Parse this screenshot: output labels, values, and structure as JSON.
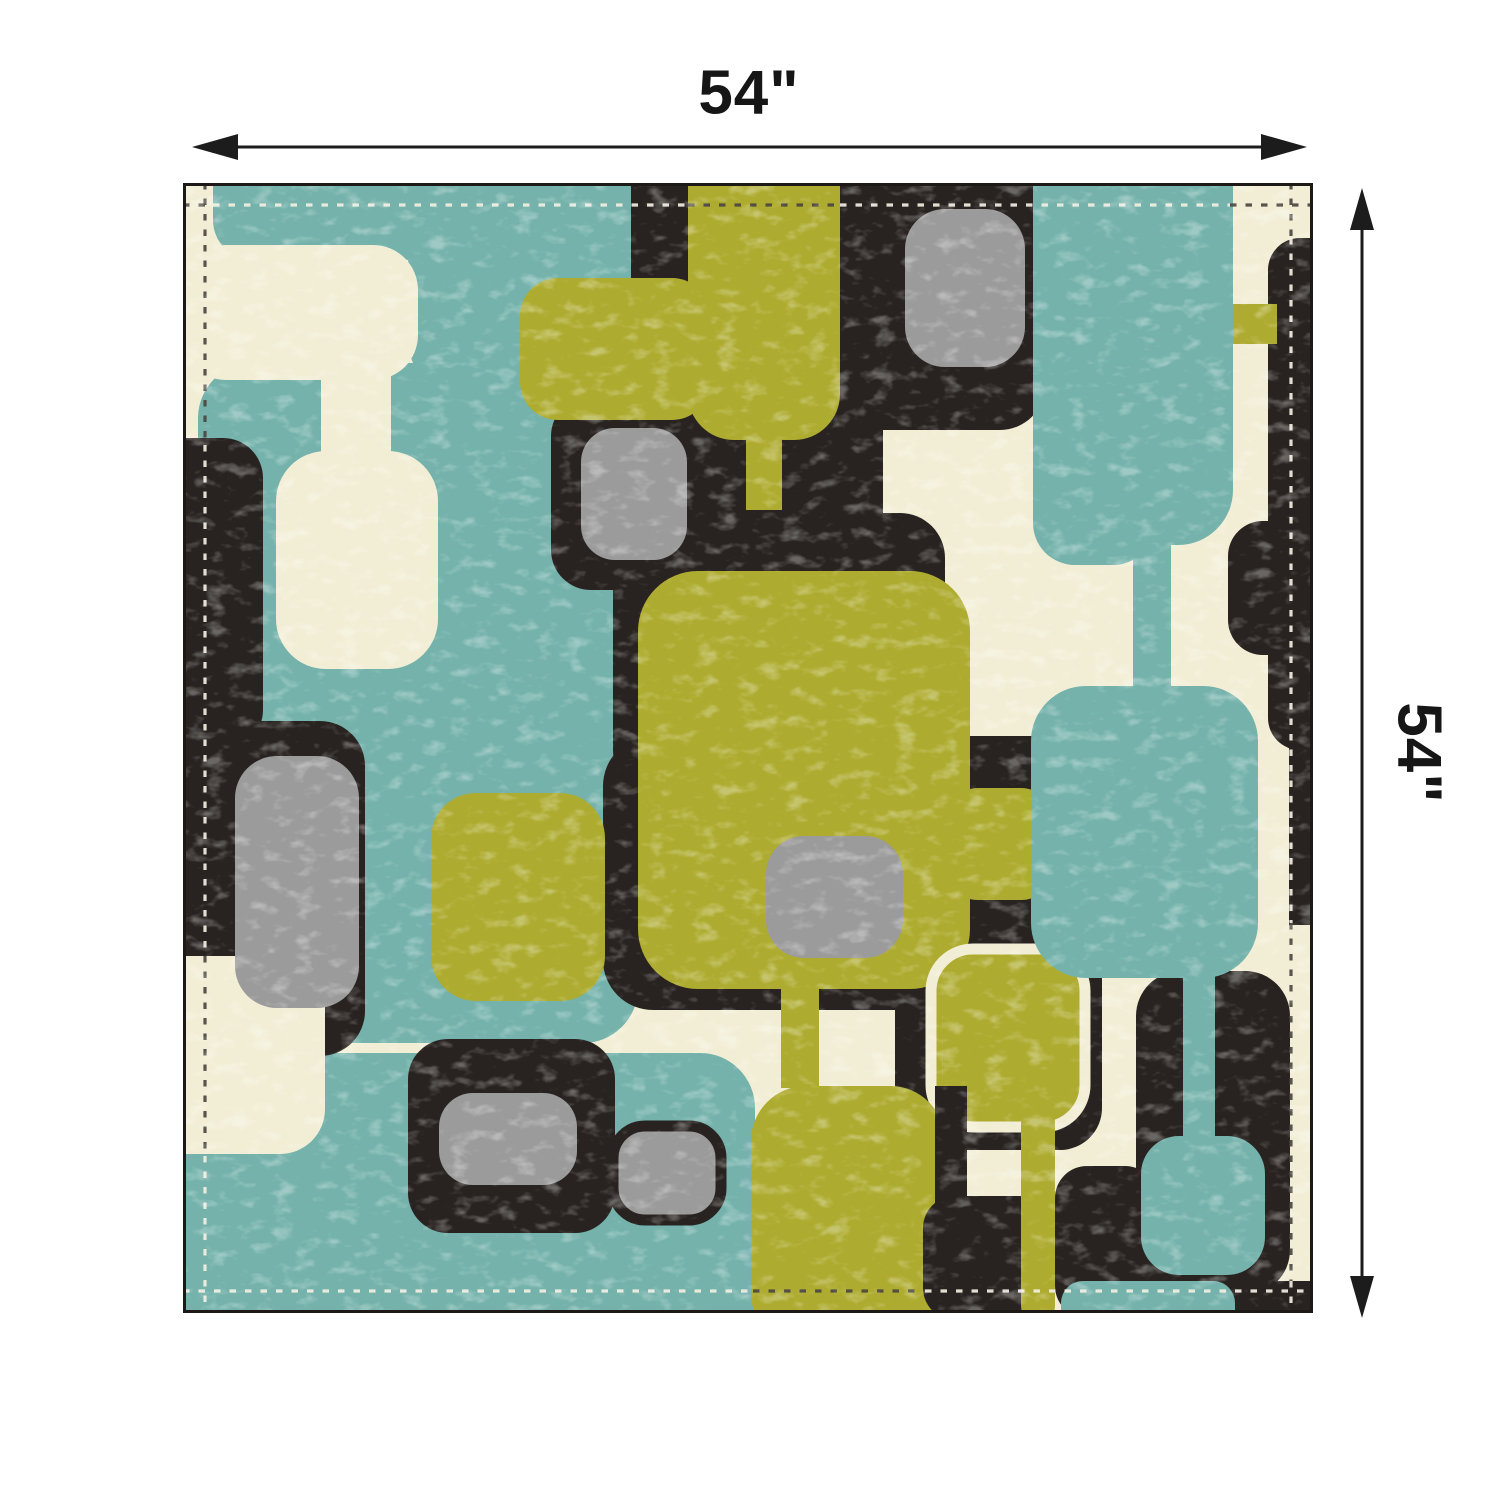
{
  "dimensions": {
    "width_label": "54\"",
    "height_label": "54\""
  },
  "annotation": {
    "arrow_color": "#1c1c1c",
    "horizontal_arrow": {
      "y": 147,
      "tip1": 192,
      "tip2": 1307,
      "head_len": 46,
      "head_half": 13
    },
    "vertical_arrow": {
      "x": 1362,
      "tip1": 188,
      "tip2": 1318,
      "head_len": 42,
      "head_half": 12
    }
  },
  "fabric": {
    "size": 1130,
    "border_color": "#1c1916",
    "palette": {
      "teal": "#74b2ab",
      "black": "#282320",
      "cream": "#f2eed6",
      "olive": "#aeac30",
      "gray": "#9b9b9b",
      "stitch_light": "#f2efe2",
      "stitch_dark": "#4c4742"
    },
    "layers": [
      {
        "name": "teal-bodies",
        "fill": "teal",
        "shapes": [
          [
            30,
            -50,
            430,
            127,
            40
          ],
          [
            225,
            -50,
            230,
            262,
            55
          ],
          [
            15,
            180,
            440,
            680,
            55
          ],
          [
            -50,
            870,
            622,
            310,
            55
          ]
        ]
      },
      {
        "name": "black-under",
        "fill": "black",
        "shapes": [
          [
            -50,
            255,
            130,
            312,
            40
          ]
        ]
      },
      {
        "name": "cream-panel",
        "fill": "cream",
        "shapes": [
          [
            -2,
            62,
            237,
            135,
            45
          ],
          [
            138,
            183,
            70,
            100,
            0
          ],
          [
            93,
            268,
            162,
            218,
            50
          ]
        ]
      },
      {
        "name": "black-main",
        "fill": "black",
        "shapes": [
          [
            -50,
            538,
            232,
            335,
            45
          ],
          [
            448,
            -50,
            252,
            522,
            45
          ],
          [
            655,
            -50,
            207,
            297,
            45
          ],
          [
            368,
            213,
            164,
            194,
            40
          ],
          [
            430,
            330,
            332,
            282,
            45
          ],
          [
            420,
            553,
            502,
            274,
            50
          ],
          [
            225,
            856,
            207,
            194,
            40
          ],
          [
            712,
            738,
            207,
            229,
            42
          ],
          [
            1085,
            55,
            95,
            512,
            32
          ],
          [
            1106,
            540,
            74,
            202,
            0
          ],
          [
            1045,
            338,
            135,
            134,
            35
          ],
          [
            953,
            788,
            154,
            324,
            45
          ],
          [
            1043,
            1098,
            137,
            82,
            22
          ]
        ]
      },
      {
        "name": "cream-notch",
        "fill": "cream",
        "shapes": [
          [
            -50,
            773,
            192,
            198,
            45
          ]
        ]
      },
      {
        "name": "olive",
        "fill": "olive",
        "shapes": [
          [
            337,
            95,
            190,
            142,
            38
          ],
          [
            505,
            -50,
            152,
            307,
            46
          ],
          [
            563,
            255,
            36,
            72,
            0
          ],
          [
            1030,
            121,
            64,
            40,
            0
          ],
          [
            455,
            388,
            332,
            418,
            60
          ],
          [
            598,
            804,
            38,
            101,
            0
          ],
          [
            248,
            610,
            174,
            208,
            45
          ],
          [
            763,
            605,
            107,
            112,
            32
          ],
          {
            "r": [
              748,
              766,
              154,
              178,
              42
            ],
            "stroke": "cream",
            "sw": 11
          },
          [
            568,
            903,
            194,
            262,
            55
          ]
        ]
      },
      {
        "name": "gray",
        "fill": "gray",
        "shapes": [
          [
            722,
            26,
            120,
            158,
            40
          ],
          [
            398,
            245,
            106,
            132,
            34
          ],
          [
            52,
            573,
            124,
            252,
            42
          ],
          [
            583,
            653,
            137,
            122,
            38
          ],
          [
            256,
            910,
            138,
            92,
            34
          ],
          {
            "r": [
              430,
              943,
              108,
              94,
              32
            ],
            "stroke": "black",
            "sw": 11
          }
        ]
      },
      {
        "name": "black-over",
        "fill": "black",
        "shapes": [
          [
            752,
            903,
            32,
            122,
            0
          ],
          [
            740,
            1013,
            128,
            124,
            32
          ],
          [
            872,
            983,
            102,
            152,
            32
          ]
        ]
      },
      {
        "name": "olive-over",
        "fill": "olive",
        "shapes": [
          [
            838,
            903,
            34,
            234,
            14
          ]
        ]
      },
      {
        "name": "teal-over",
        "fill": "teal",
        "shapes": [
          [
            850,
            -50,
            200,
            412,
            55
          ],
          [
            850,
            198,
            122,
            184,
            42
          ],
          [
            950,
            358,
            38,
            164,
            0
          ],
          [
            848,
            503,
            227,
            292,
            55
          ],
          [
            1000,
            778,
            32,
            194,
            0
          ],
          [
            958,
            953,
            124,
            139,
            38
          ],
          [
            878,
            1098,
            174,
            64,
            22
          ]
        ]
      }
    ],
    "stitch": {
      "inset": 22,
      "width": 3.2,
      "dash": "6.5 9",
      "segments": {
        "top": [
          [
            0,
            30,
            "dark"
          ],
          [
            30,
            505,
            "light"
          ],
          [
            505,
            657,
            "dark"
          ],
          [
            657,
            1047,
            "light"
          ],
          [
            1047,
            1130,
            "dark"
          ]
        ],
        "right": [
          [
            0,
            55,
            "dark"
          ],
          [
            55,
            740,
            "light"
          ],
          [
            740,
            1098,
            "dark"
          ],
          [
            1098,
            1130,
            "light"
          ]
        ],
        "bottom": [
          [
            0,
            570,
            "light"
          ],
          [
            570,
            742,
            "dark"
          ],
          [
            742,
            1130,
            "light"
          ]
        ],
        "left": [
          [
            0,
            262,
            "dark"
          ],
          [
            262,
            773,
            "light"
          ],
          [
            773,
            973,
            "dark"
          ],
          [
            973,
            1130,
            "light"
          ]
        ]
      }
    }
  }
}
